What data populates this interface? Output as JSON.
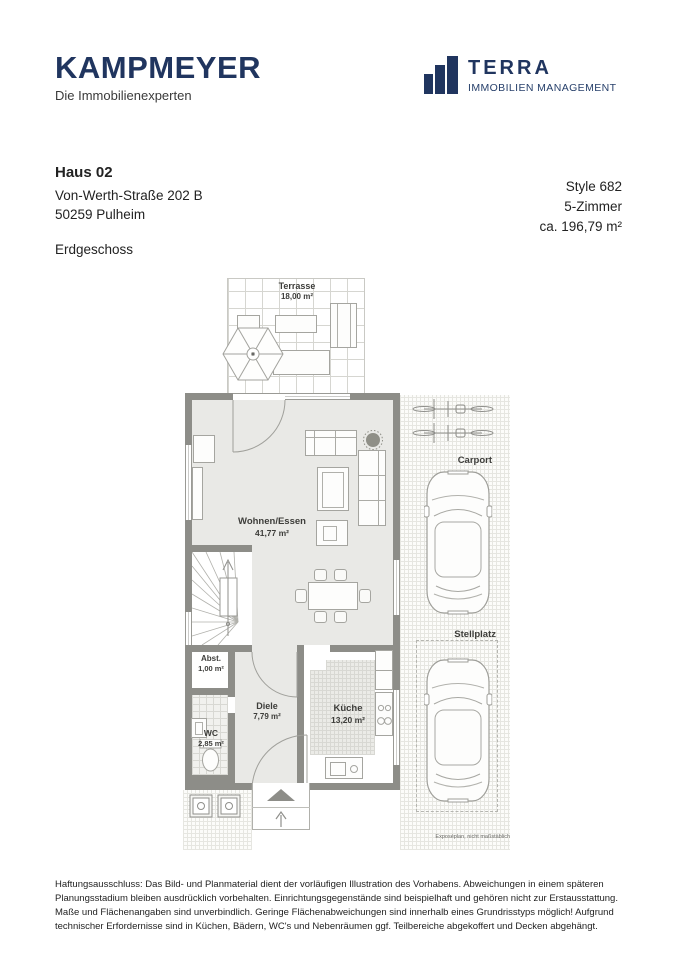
{
  "header": {
    "kampmeyer": {
      "wordmark": "KAMPMEYER",
      "tagline": "Die Immobilienexperten"
    },
    "terra": {
      "wordmark": "TERRA",
      "tagline": "IMMOBILIEN MANAGEMENT"
    }
  },
  "property": {
    "house": "Haus 02",
    "street": "Von-Werth-Straße 202 B",
    "city": "50259 Pulheim",
    "level": "Erdgeschoss",
    "style": "Style 682",
    "rooms": "5-Zimmer",
    "area": "ca. 196,79 m²"
  },
  "floorplan": {
    "rooms": [
      {
        "name": "Terrasse",
        "area": "18,00 m²"
      },
      {
        "name": "Wohnen/Essen",
        "area": "41,77 m²"
      },
      {
        "name": "Abst.",
        "area": "1,00 m²"
      },
      {
        "name": "Diele",
        "area": "7,79 m²"
      },
      {
        "name": "WC",
        "area": "2,85 m²"
      },
      {
        "name": "Küche",
        "area": "13,20 m²"
      }
    ],
    "outdoor": {
      "carport": "Carport",
      "stellplatz": "Stellplatz"
    },
    "note": "Exposéplan, nicht maßstäblich"
  },
  "icons": {
    "terra_logo": "bar-chart",
    "entrance": "arrow-up",
    "parasol": "hexagonal-umbrella"
  },
  "colors": {
    "brand_navy": "#20355f",
    "wall": "#8d8d88",
    "floor": "#e9e9e6",
    "text": "#222222"
  },
  "disclaimer": "Haftungsausschluss: Das Bild- und Planmaterial dient der vorläufigen Illustration des Vorhabens. Abweichungen in einem späteren Planungsstadium bleiben ausdrücklich vorbehalten. Einrichtungsgegenstände sind beispielhaft und gehören nicht zur Erstausstattung. Maße und Flächenangaben sind unverbindlich. Geringe Flächenabweichungen sind innerhalb eines Grundrisstyps möglich! Aufgrund technischer Erfordernisse sind in Küchen, Bädern, WC's und Nebenräumen ggf. Teilbereiche abgekoffert und Decken abgehängt."
}
